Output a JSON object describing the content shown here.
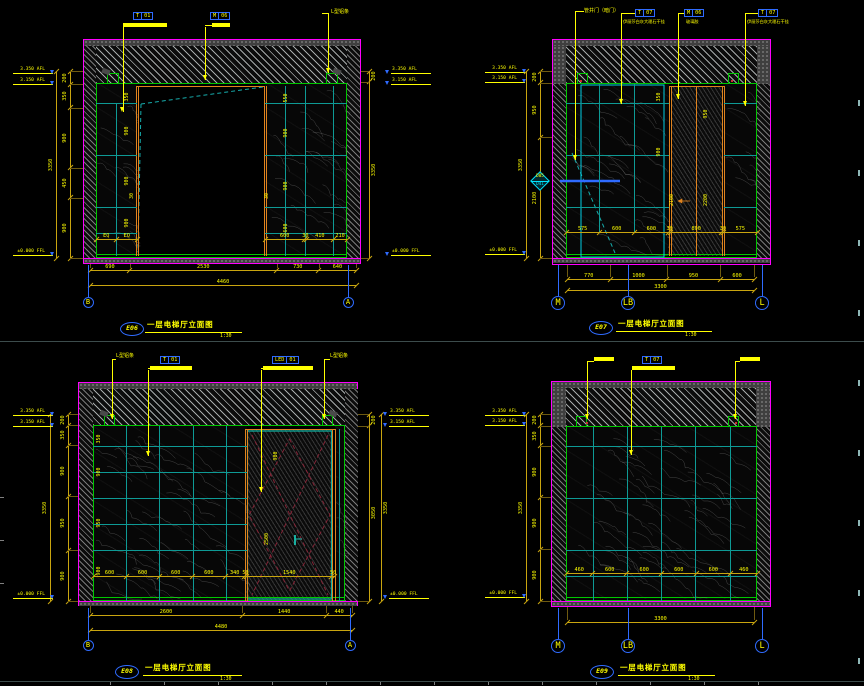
{
  "document": {
    "type": "CAD elevation sheet",
    "background": "#000000"
  },
  "colors": {
    "yellow": "#ffff00",
    "magenta": "#ff00ff",
    "green": "#00c800",
    "teal": "#0e9a95",
    "cyan": "#00e5ff",
    "orange": "#e0831e",
    "dim_gold": "#c9a50f",
    "ext": "#6e5a10",
    "blue": "#2f6bff",
    "red": "#d03030",
    "dark_red": "#8b2438",
    "handle": "#19c0b0",
    "separator": "#3c4c4c"
  },
  "panels": [
    {
      "id": "E06",
      "tag": "E06",
      "title": "一层电梯厅立面图",
      "scale": "1:30",
      "callouts": [
        {
          "cells": [
            "T",
            "01"
          ]
        },
        {
          "cells": [
            "M",
            "06"
          ]
        },
        {
          "text": "L型铝条"
        }
      ],
      "elev_left": [
        "3.350 AFL",
        "3.150 AFL",
        "±0.000 FFL"
      ],
      "elev_right": [
        "3.350 AFL",
        "3.150 AFL",
        "±0.000 FFL"
      ],
      "dims_left": {
        "segments": [
          "200",
          "350",
          "900",
          "450",
          "900"
        ],
        "total": "3350"
      },
      "dims_right": {
        "segments": [
          "200",
          "3350"
        ]
      },
      "dims_bottom": {
        "segments": [
          "690",
          "2530",
          "730",
          "640"
        ],
        "total": "4460"
      },
      "inner_bottom": [
        [
          "EQ",
          "EQ"
        ],
        [
          "600",
          "30",
          "410",
          "210"
        ]
      ],
      "inner_labels": [
        "350",
        "900",
        "900",
        "900",
        "550",
        "900",
        "900",
        "600",
        "30",
        "30"
      ],
      "grid_bubbles": [
        "B",
        "A"
      ]
    },
    {
      "id": "E07",
      "tag": "E07",
      "title": "一层电梯厅立面图",
      "scale": "1:30",
      "callouts": [
        {
          "text": "管井门（暗门）"
        },
        {
          "cells": [
            "T",
            "07"
          ],
          "note": "伊丽莎白灰大理石干挂"
        },
        {
          "cells": [
            "M",
            "06"
          ],
          "note": "玻璃胶"
        },
        {
          "cells": [
            "T",
            "07"
          ],
          "note": "伊丽莎白灰大理石干挂"
        }
      ],
      "elev_left": [
        "3.350 AFL",
        "3.150 AFL",
        "±0.000 FFL"
      ],
      "elev_right": [],
      "dims_left": {
        "segments": [
          "200",
          "950",
          "2100"
        ],
        "total": "3350"
      },
      "dims_bottom": {
        "segments": [
          "770",
          "1000",
          "950",
          "600"
        ],
        "total": "3300"
      },
      "inner_bottom": [
        [
          "575",
          "600",
          "600",
          "30",
          "890",
          "30",
          "575"
        ]
      ],
      "inner_labels": [
        "350",
        "950",
        "900",
        "2100",
        "2200"
      ],
      "section_tag": {
        "top": "D05",
        "bottom": "D41"
      },
      "grid_bubbles": [
        "M",
        "LB",
        "L"
      ]
    },
    {
      "id": "E08",
      "tag": "E08",
      "title": "一层电梯厅立面图",
      "scale": "1:30",
      "callouts": [
        {
          "text": "L型铝条"
        },
        {
          "cells": [
            "T",
            "01"
          ]
        },
        {
          "cells": [
            "LED",
            "01"
          ]
        },
        {
          "text": "L型铝条"
        }
      ],
      "elev_left": [
        "3.350 AFL",
        "3.150 AFL",
        "±0.000 FFL"
      ],
      "elev_right": [
        "3.350 AFL",
        "3.150 AFL",
        "±0.000 FFL"
      ],
      "dims_left": {
        "segments": [
          "200",
          "350",
          "900",
          "950",
          "900"
        ],
        "total": "3350"
      },
      "dims_right": {
        "segments": [
          "200",
          "3050"
        ],
        "total": "3350"
      },
      "dims_bottom": {
        "segments": [
          "2600",
          "1440",
          "440"
        ],
        "total": "4480"
      },
      "inner_bottom": [
        [
          "600",
          "600",
          "600",
          "600",
          "340",
          "50",
          "1540",
          "50"
        ]
      ],
      "inner_labels": [
        "350",
        "900",
        "950",
        "900",
        "900",
        "2500"
      ],
      "grid_bubbles": [
        "B",
        "A"
      ]
    },
    {
      "id": "E09",
      "tag": "E09",
      "title": "一层电梯厅立面图",
      "scale": "1:30",
      "callouts": [
        {
          "bar": true
        },
        {
          "cells": [
            "T",
            "07"
          ]
        },
        {
          "bar": true
        }
      ],
      "elev_left": [
        "3.350 AFL",
        "3.150 AFL",
        "±0.000 FFL"
      ],
      "elev_right": [],
      "dims_left": {
        "segments": [
          "200",
          "350",
          "900",
          "900",
          "900"
        ],
        "total": "3350"
      },
      "dims_bottom": {
        "segments": [
          "3300"
        ]
      },
      "inner_bottom": [
        [
          "460",
          "600",
          "600",
          "600",
          "600",
          "460"
        ]
      ],
      "inner_labels": [],
      "grid_bubbles": [
        "M",
        "LB",
        "L"
      ]
    }
  ]
}
